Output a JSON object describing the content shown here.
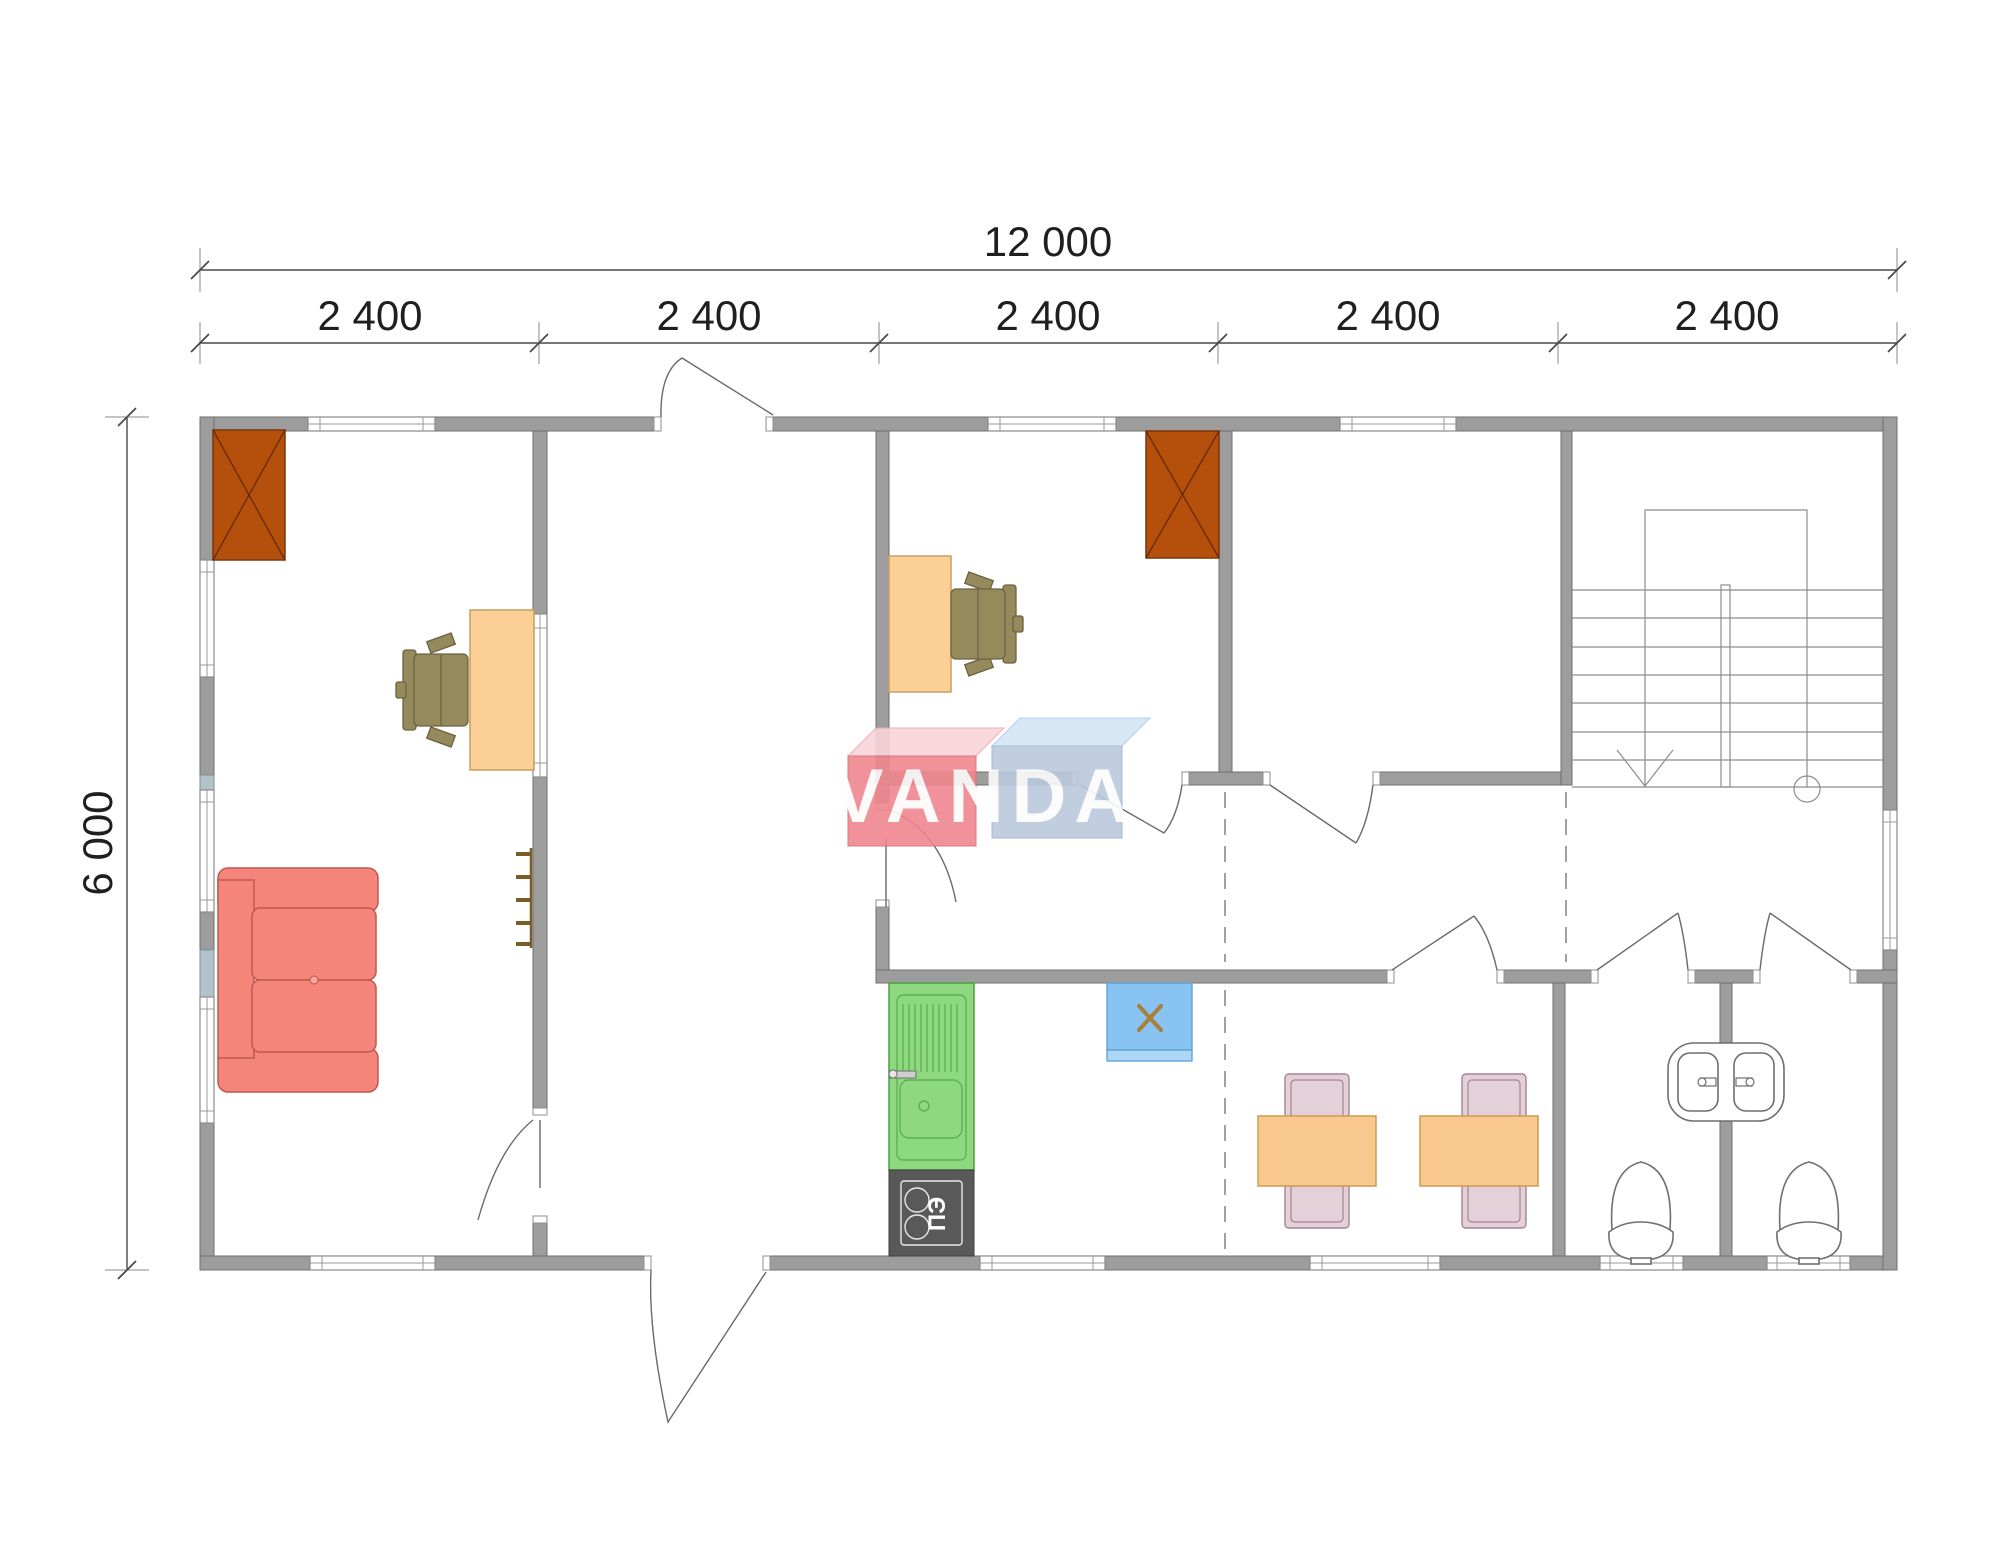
{
  "drawing": {
    "type": "architectural floor plan",
    "scale_note": "modular building 12000 x 6000 mm, five 2400 mm modules"
  },
  "dimensions": {
    "overall_width": "12 000",
    "segments": [
      "2 400",
      "2 400",
      "2 400",
      "2 400",
      "2 400"
    ],
    "overall_height": "6 000"
  },
  "appliances": {
    "stove_label": "ПЭ"
  },
  "watermark": {
    "text": "VANDA",
    "box1_front_color": "#f0868e",
    "box1_top_color": "#f8d4da",
    "box2_front_color": "#bac9dc",
    "box2_top_color": "#d3e5f6",
    "text_color": "#ffffff"
  },
  "colors": {
    "wall": "#9d9d9d",
    "wall_accent": "#b3c2c9",
    "fireplace": "#b5500c",
    "desk": "#fbcf96",
    "office_chair": "#948a5c",
    "sofa": "#f5847b",
    "kitchen_unit": "#8ed87f",
    "stove": "#595959",
    "fridge": "#88c3f2",
    "dining_table": "#f8c88e",
    "dining_chair": "#e4d0d8",
    "dimension_text": "#1f1f1f"
  },
  "icons": {
    "fireplace": "crossed-box",
    "stair_direction": "down-arrow",
    "door": "quarter-arc-swing",
    "toilet": "bowl-and-tank",
    "double-basin": "stadium-console"
  }
}
